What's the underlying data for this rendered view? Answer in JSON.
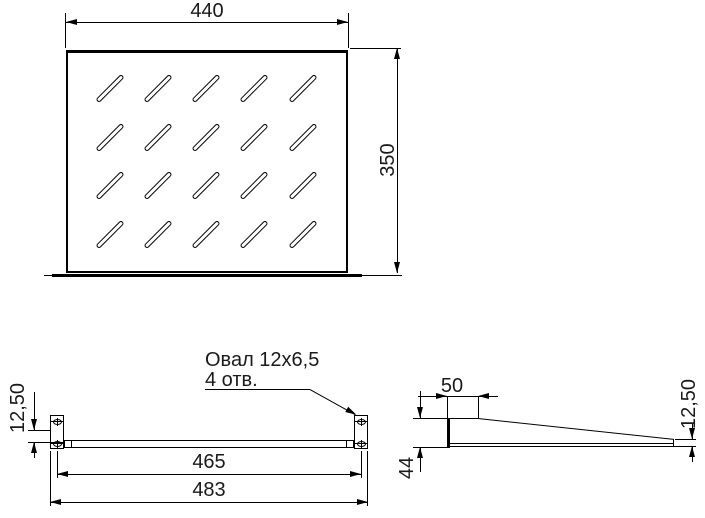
{
  "drawing": {
    "background_color": "#ffffff",
    "line_color": "#000000",
    "views": {
      "top": {
        "width_dim": "440",
        "height_dim": "350",
        "ventilation_slots": {
          "rows": 4,
          "columns": 5
        }
      },
      "front": {
        "callout_line1": "Овал 12x6,5",
        "callout_line2": "4 отв.",
        "ear_offset_dim": "12,50",
        "mount_spacing_dim": "465",
        "overall_width_dim": "483"
      },
      "side": {
        "flat_depth_dim": "50",
        "front_height_dim": "44",
        "rear_height_dim": "12,50"
      }
    }
  }
}
